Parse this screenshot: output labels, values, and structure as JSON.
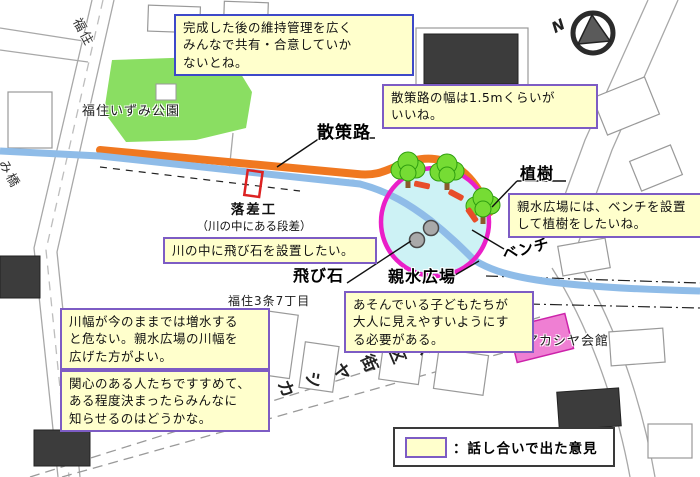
{
  "notes": {
    "maintenance": "完成した後の維持管理を広く\nみんなで共有・合意していか\nないとね。",
    "path_width": "散策路の幅は1.5mくらいが\nいいね。",
    "bench_planting": "親水広場には、ベンチを設置\nして植樹をしたいね。",
    "stepping_stones": "川の中に飛び石を設置したい。",
    "visibility": "あそんでいる子どもたちが\n大人に見えやすいようにす\nる必要がある。",
    "river_width": "川幅が今のままでは増水する\nと危ない。親水広場の川幅を\n広げた方がよい。",
    "outreach": "関心のある人たちですすめて、\nある程度決まったらみんなに\n知らせるのはどうかな。"
  },
  "features": {
    "walking_path": "散策路",
    "planting": "植樹",
    "bench": "ベンチ",
    "stepping_stone": "飛び石",
    "water_plaza": "親水広場",
    "drop_structure": "落差工",
    "drop_structure_sub": "（川の中にある段差）"
  },
  "places": {
    "izumi_park": "福住いずみ公園",
    "chome": "福住3条7丁目",
    "akashiya_hall": "福住アカシヤ会館",
    "street_fukuzumi": "福住",
    "street_bridge": "み橋",
    "street_akashiya_block": "福住アカシヤ街区公園"
  },
  "legend": {
    "separator": "：",
    "label": "話し合いで出た意見"
  },
  "compass": {
    "n": "N"
  },
  "colors": {
    "note_bg": "#ffffcc",
    "note_border": "#7d5cc4",
    "note_border_blue": "#3d49c8",
    "walking_path": "#f07820",
    "river": "#8fbce8",
    "plaza_ring": "#ea1fc8",
    "plaza_fill": "#cdf2f5",
    "park_green": "#8ade62",
    "tree_green": "#76dc34",
    "bench_mark": "#e84d2a",
    "hall_pink": "#ef7fd3",
    "drop_marker": "#dd2222"
  }
}
